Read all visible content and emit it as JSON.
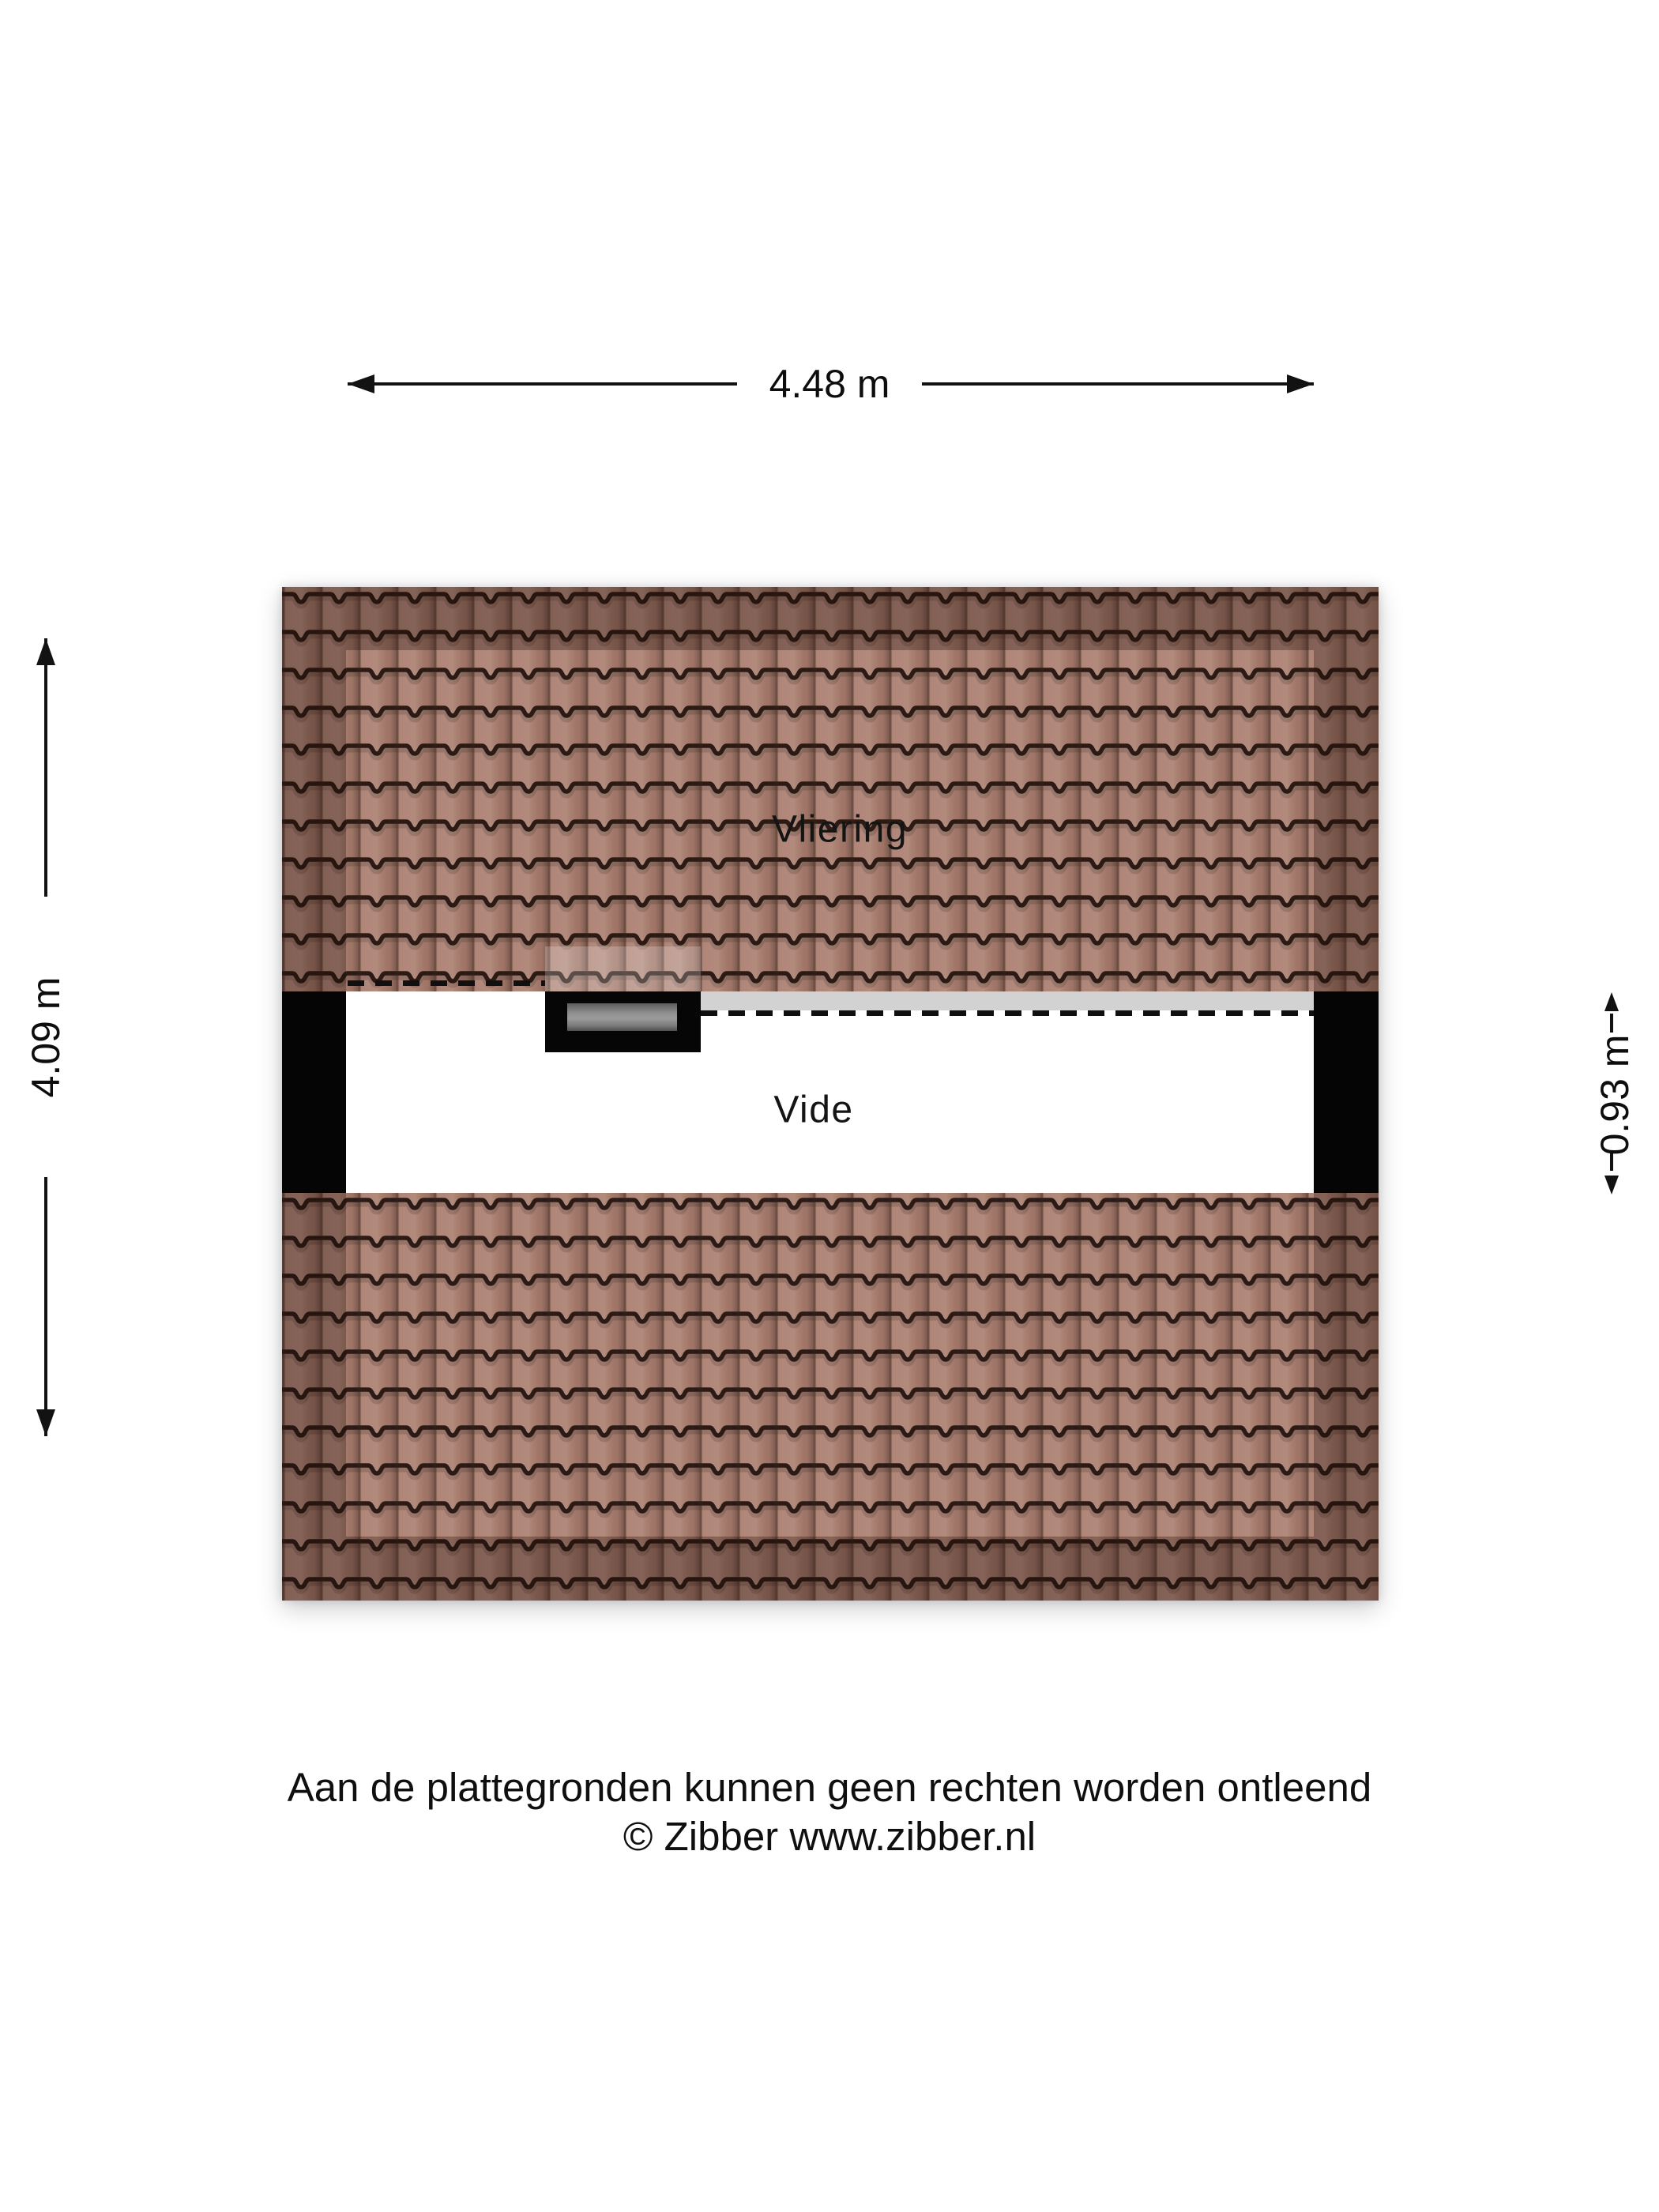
{
  "floorplan": {
    "labels": {
      "vliering": "Vliering",
      "vide": "Vide"
    },
    "dimensions": {
      "width": {
        "label": "4.48 m"
      },
      "height": {
        "label": "4.09 m"
      },
      "vide_height": {
        "label": "0.93 m"
      }
    },
    "colors": {
      "tile_base": "#a87b6c",
      "tile_joint_line": "#2c1b15",
      "eaves_band_overlay": "rgba(30,10,3,0.30)",
      "wall_bar": "#050505",
      "edge_gray_band": "#d2d2d2",
      "skylight_frame": "#060606",
      "skylight_pane": "#8f8f8f",
      "dashed_line": "#101010"
    }
  },
  "footer": {
    "line1": "Aan de plattegronden kunnen geen rechten worden ontleend",
    "line2": "© Zibber www.zibber.nl"
  }
}
